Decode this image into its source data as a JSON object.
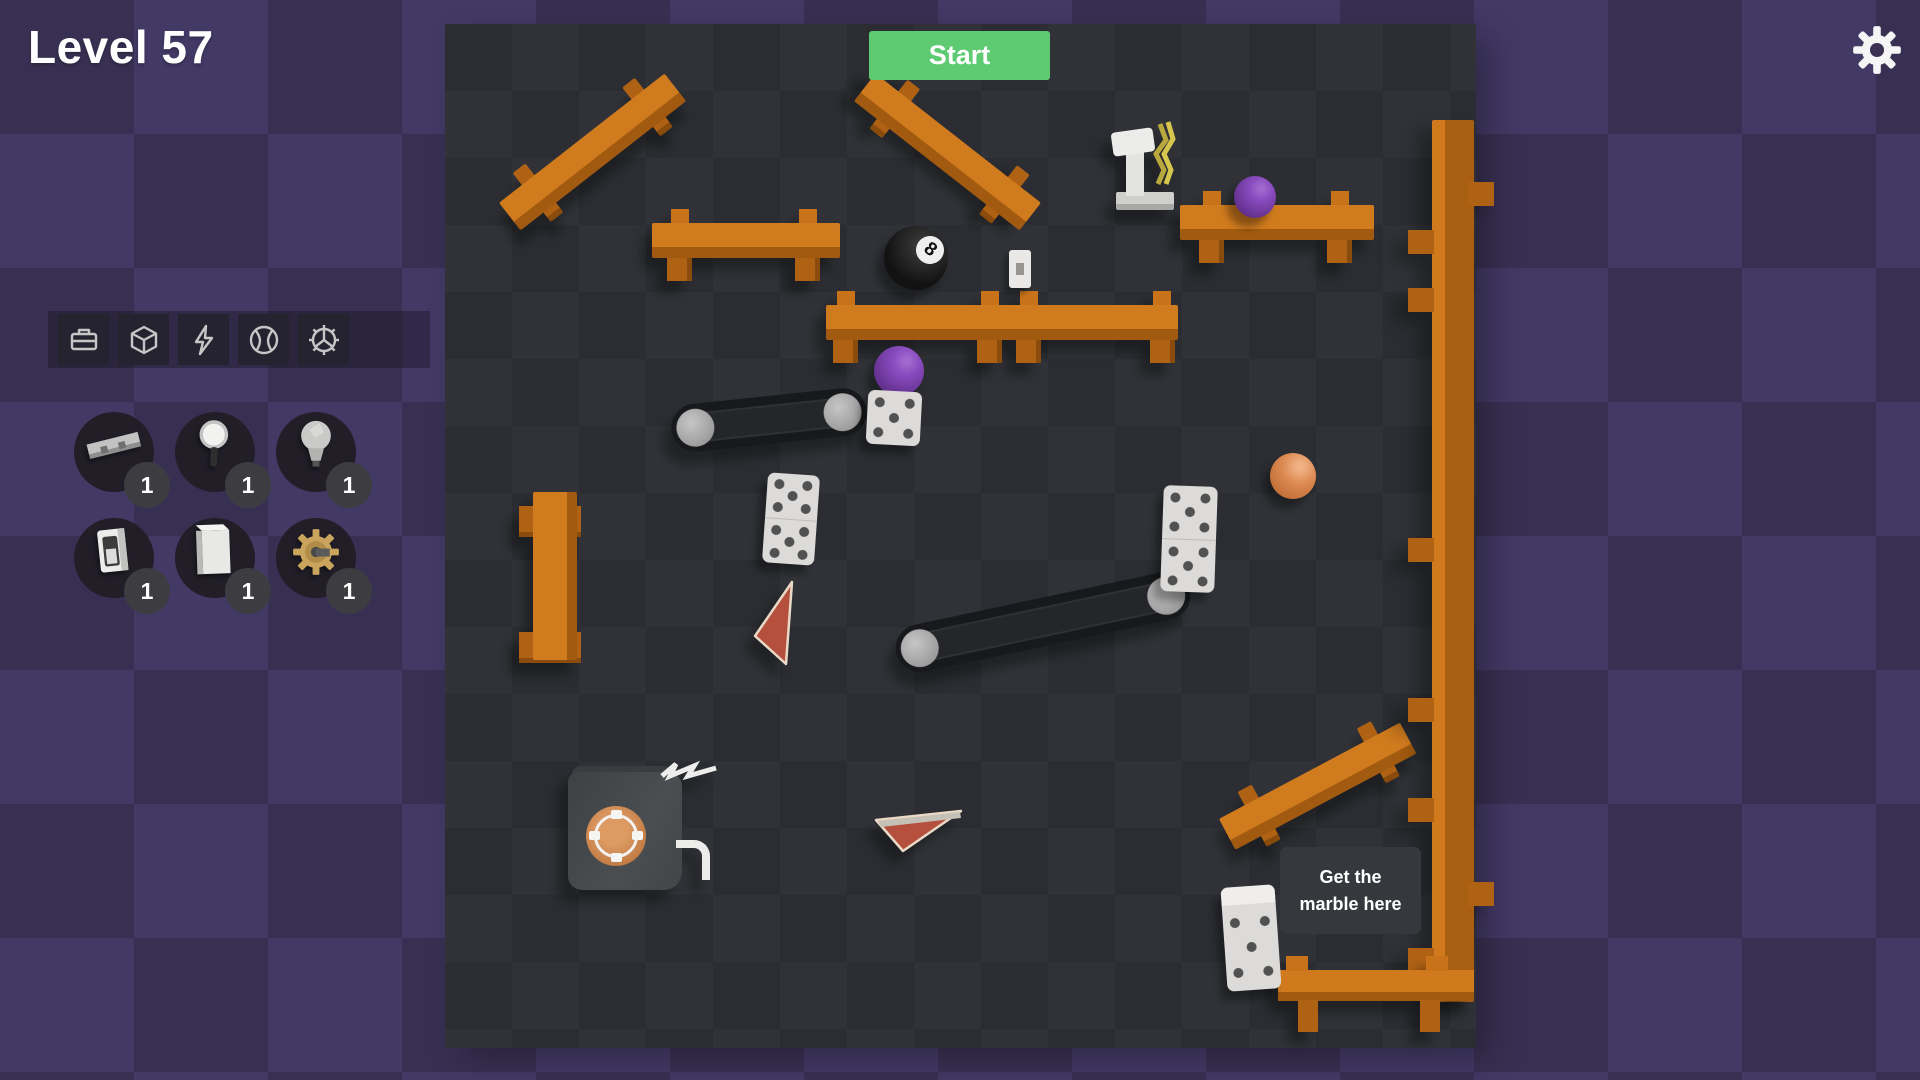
{
  "app": {
    "level_title": "Level 57"
  },
  "header": {
    "start_button": "Start",
    "settings_icon": "gear-icon"
  },
  "toolbar": {
    "categories": [
      {
        "icon": "toolbox-icon"
      },
      {
        "icon": "cube-icon"
      },
      {
        "icon": "lightning-icon"
      },
      {
        "icon": "ball-icon"
      },
      {
        "icon": "gear-3d-icon"
      }
    ]
  },
  "inventory": {
    "items": [
      {
        "name": "seesaw-plank",
        "count": "1"
      },
      {
        "name": "magnifying-glass",
        "count": "1"
      },
      {
        "name": "lightbulb",
        "count": "1"
      },
      {
        "name": "light-switch",
        "count": "1"
      },
      {
        "name": "book",
        "count": "1"
      },
      {
        "name": "golden-gear",
        "count": "1"
      }
    ]
  },
  "board": {
    "goal_line1": "Get the",
    "goal_line2": "marble here",
    "eight_ball_label": "8",
    "objects": [
      "wooden benches",
      "wooden wall",
      "conveyor belts",
      "dominoes",
      "dice",
      "purple marbles",
      "orange ball",
      "eight ball",
      "red ramps",
      "pot dispenser",
      "hammer device",
      "wall switch"
    ]
  },
  "colors": {
    "start_button": "#5ecb72",
    "wood": "#cf7a1e",
    "background_purple": "#383052",
    "board_dark": "#2b2d32",
    "marble_purple": "#7b43ae",
    "ball_orange": "#dd8a52",
    "ramp_red": "#b5503f"
  }
}
